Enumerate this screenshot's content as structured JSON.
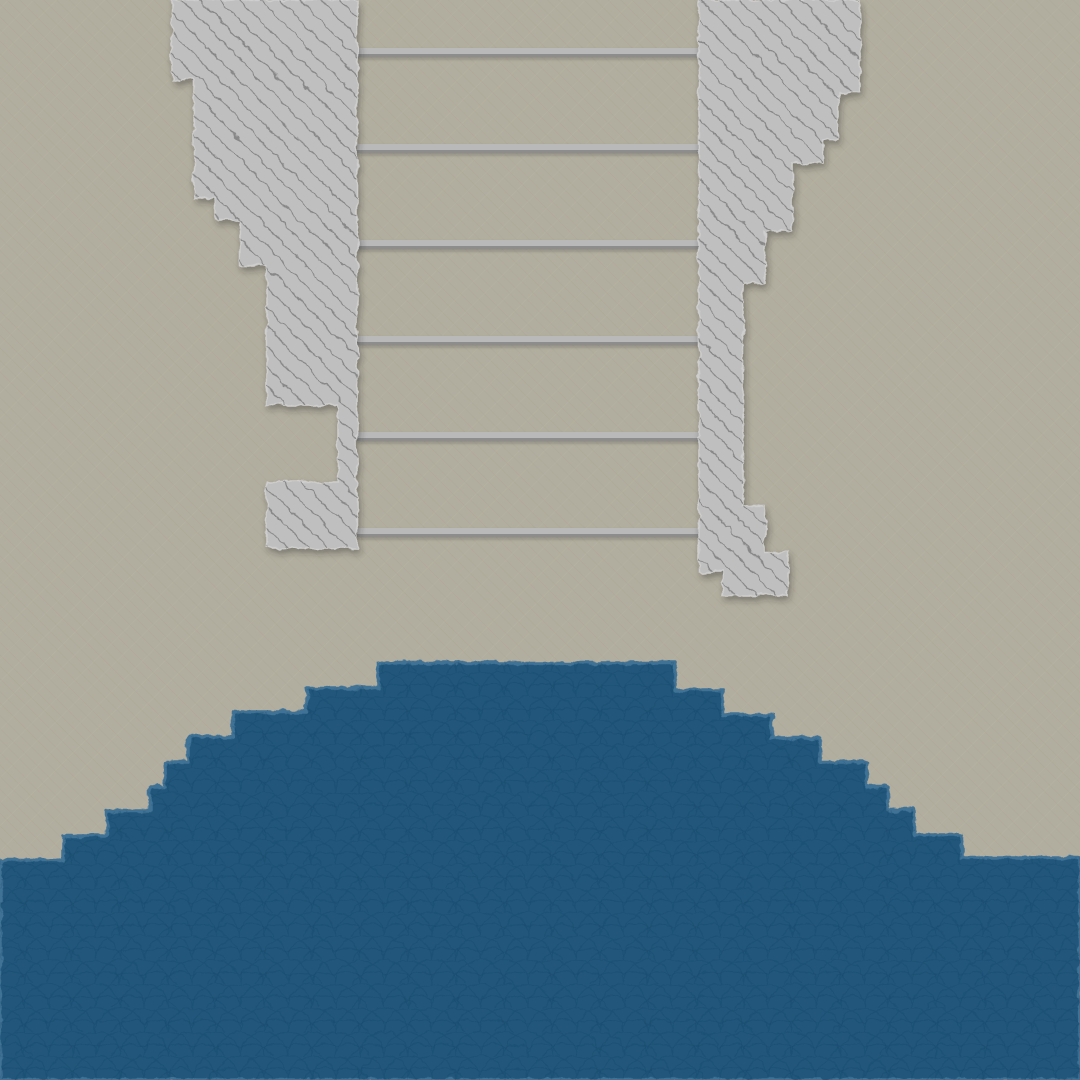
{
  "scene": {
    "width": 1080,
    "height": 1080,
    "colors": {
      "background": "#b2ae9f",
      "background_streak": "#8d8474",
      "block_fill": "#bfbfbf",
      "block_edge": "#cecece",
      "block_hatch": "#7a7a7a",
      "water_fill": "#20567a",
      "water_rim": "#3f7295",
      "water_line": "#153f5c",
      "rung_face": "#b9b9b9",
      "rung_under": "#8d8d8d",
      "shadow": "#222222"
    }
  },
  "terrain": {
    "left_block_points": [
      [
        172,
        0
      ],
      [
        357,
        0
      ],
      [
        357,
        548
      ],
      [
        267,
        548
      ],
      [
        267,
        482
      ],
      [
        338,
        482
      ],
      [
        338,
        405
      ],
      [
        267,
        405
      ],
      [
        267,
        265
      ],
      [
        240,
        265
      ],
      [
        240,
        220
      ],
      [
        216,
        220
      ],
      [
        216,
        198
      ],
      [
        194,
        198
      ],
      [
        194,
        80
      ],
      [
        172,
        80
      ]
    ],
    "right_block_points": [
      [
        699,
        0
      ],
      [
        860,
        0
      ],
      [
        860,
        92
      ],
      [
        838,
        92
      ],
      [
        838,
        140
      ],
      [
        823,
        140
      ],
      [
        823,
        163
      ],
      [
        792,
        163
      ],
      [
        792,
        231
      ],
      [
        765,
        231
      ],
      [
        765,
        283
      ],
      [
        743,
        283
      ],
      [
        743,
        505
      ],
      [
        765,
        505
      ],
      [
        765,
        552
      ],
      [
        788,
        552
      ],
      [
        788,
        595
      ],
      [
        723,
        595
      ],
      [
        723,
        572
      ],
      [
        699,
        572
      ]
    ],
    "water_points": [
      [
        0,
        860
      ],
      [
        63,
        860
      ],
      [
        63,
        836
      ],
      [
        107,
        836
      ],
      [
        107,
        811
      ],
      [
        150,
        811
      ],
      [
        150,
        787
      ],
      [
        165,
        787
      ],
      [
        165,
        762
      ],
      [
        188,
        762
      ],
      [
        188,
        737
      ],
      [
        233,
        737
      ],
      [
        233,
        712
      ],
      [
        307,
        712
      ],
      [
        307,
        688
      ],
      [
        378,
        688
      ],
      [
        378,
        663
      ],
      [
        675,
        663
      ],
      [
        675,
        690
      ],
      [
        723,
        690
      ],
      [
        723,
        715
      ],
      [
        772,
        715
      ],
      [
        772,
        738
      ],
      [
        820,
        738
      ],
      [
        820,
        762
      ],
      [
        867,
        762
      ],
      [
        867,
        787
      ],
      [
        888,
        787
      ],
      [
        888,
        810
      ],
      [
        915,
        810
      ],
      [
        915,
        835
      ],
      [
        962,
        835
      ],
      [
        962,
        858
      ],
      [
        1080,
        858
      ],
      [
        1080,
        1080
      ],
      [
        0,
        1080
      ]
    ]
  },
  "ladder": {
    "x": 357,
    "width": 343,
    "face_height": 6,
    "under_height": 3,
    "rung_tops": [
      48,
      144,
      240,
      336,
      432,
      528
    ]
  }
}
